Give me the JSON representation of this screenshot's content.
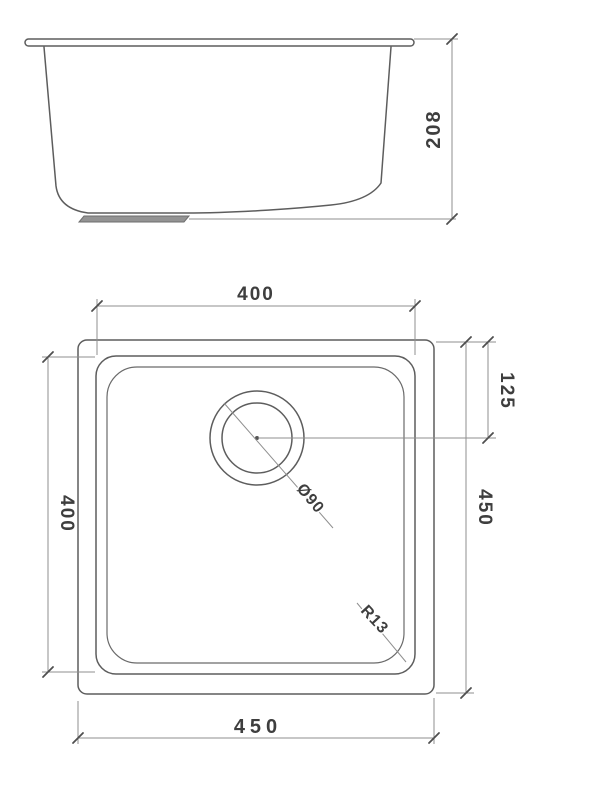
{
  "document": {
    "type": "technical-drawing",
    "subject": "undermount-square-sink",
    "background_color": "#ffffff",
    "outline_color": "#5d5d5d",
    "dimension_line_color": "#8f8f8f",
    "text_color": "#3e3e3e",
    "drain_strainer_fill": "#939393"
  },
  "side_view": {
    "name": "front-elevation",
    "dimensions": {
      "overall_height": "208"
    }
  },
  "plan_view": {
    "name": "top-plan-view",
    "dimensions": {
      "bowl_width_top": "400",
      "bowl_depth_left": "400",
      "overall_depth_right": "450",
      "overall_width_bottom": "450",
      "drain_offset_right": "125"
    },
    "callouts": {
      "drain_diameter": "Ø90",
      "corner_radius": "R13"
    }
  }
}
